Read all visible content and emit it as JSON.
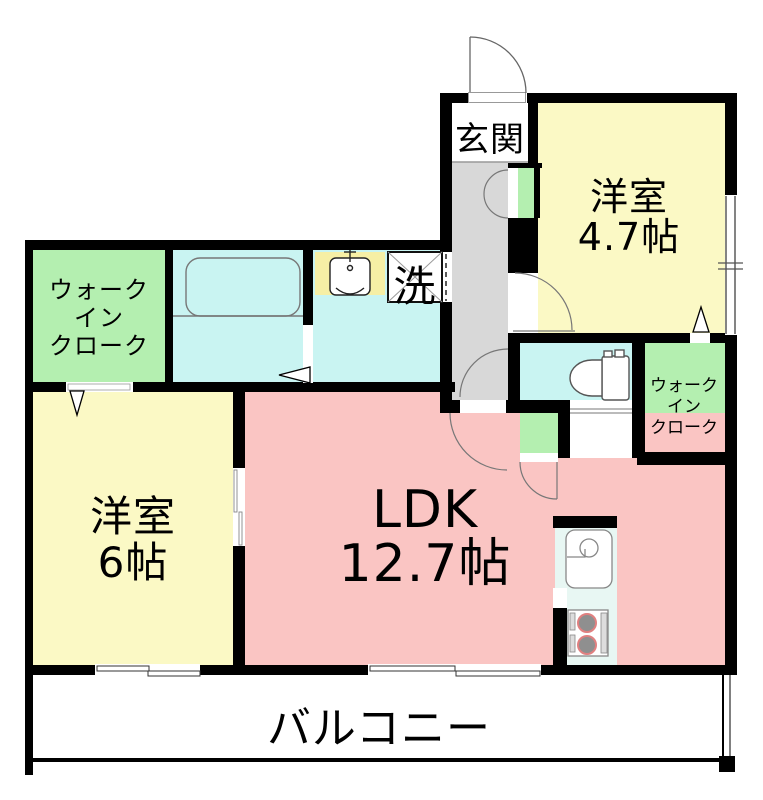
{
  "colors": {
    "wall": "#000000",
    "fixture_outline": "#777777",
    "room_yellow": "#FBF9C5",
    "room_green": "#B4EFB0",
    "room_cyan": "#C9F4F2",
    "room_pink": "#FAC5C3",
    "hallway_gray": "#D8D8D8",
    "kitchen_counter": "#E8F7F3",
    "washbasin_yellow": "#F6EFA5"
  },
  "rooms": {
    "genkan": {
      "label": "玄関"
    },
    "western_room_47": {
      "name": "洋室",
      "size": "4.7帖"
    },
    "walk_in_closet_left": {
      "lines": [
        "ウォーク",
        "イン",
        "クローク"
      ]
    },
    "walk_in_closet_right": {
      "lines": [
        "ウォーク",
        "イン",
        "クローク"
      ]
    },
    "laundry": {
      "label": "洗"
    },
    "western_room_6": {
      "name": "洋室",
      "size": "6帖"
    },
    "ldk": {
      "name": "LDK",
      "size": "12.7帖"
    },
    "balcony": {
      "label": "バルコニー"
    }
  }
}
